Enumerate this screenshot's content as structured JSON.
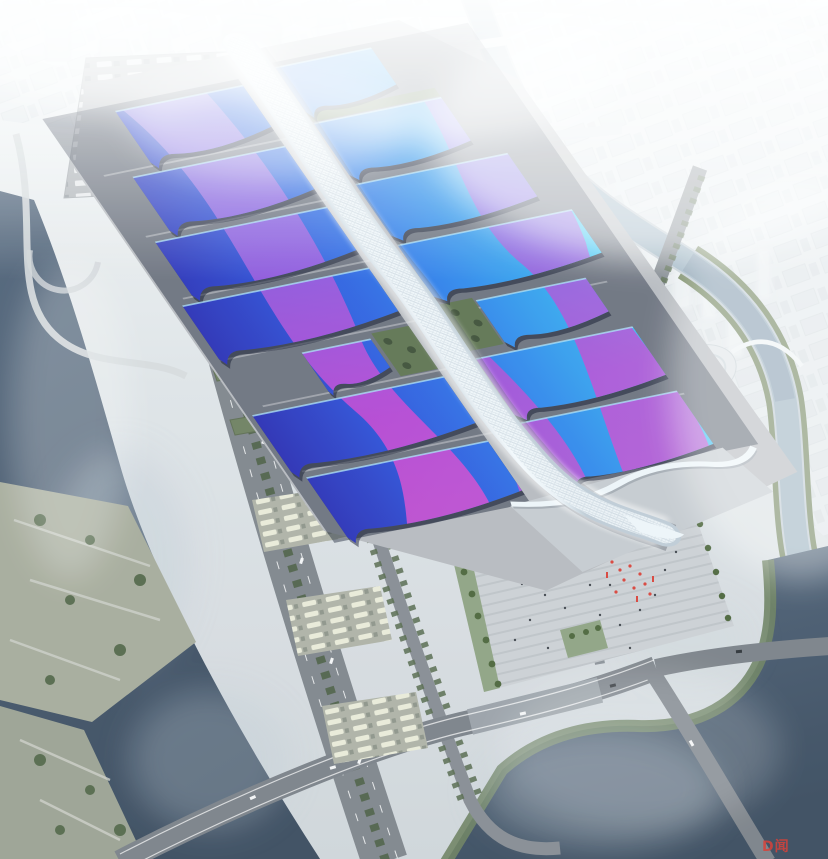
{
  "scene": {
    "description": "Aerial rendering of a riverside exhibition and convention center: paired wavy blue roof halls with purple ribbon graphics along a white serpentine central spine, truck marshalling yards, expressway with tree medians, canals and a hazy white city beyond.",
    "watermark": {
      "text": "D闻",
      "color": "#d8433a"
    }
  },
  "palette": {
    "sky_haze": "#f3f6f8",
    "ground": "#b7babf",
    "road": "#7f858c",
    "road_secondary": "#868c93",
    "water_top": "#53667c",
    "water_bottom": "#3a4b5e",
    "canal": "#9db3c2",
    "tree_green": "#55694b",
    "park_green": "#a6ab9b",
    "roof_indigo": "#2b2fb4",
    "roof_blue": "#2f7ce9",
    "roof_cyan": "#45d2f7",
    "ribbon_purple": "#9a5ade",
    "ribbon_magenta": "#c746d2",
    "spine_white": "#eef5f9",
    "plaza": "#ccd0d4",
    "accent_red": "#d8433a"
  }
}
